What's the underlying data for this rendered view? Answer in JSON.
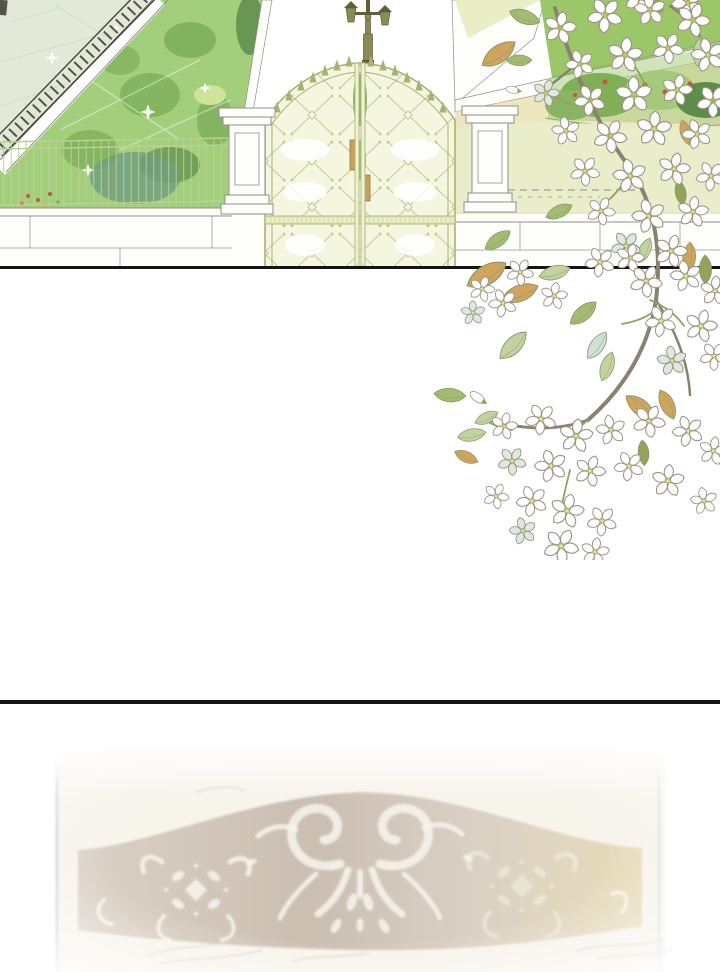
{
  "page": {
    "type": "webtoon-comic-page",
    "width": 720,
    "height": 972,
    "background": "#ffffff",
    "text_content": "none"
  },
  "panels": {
    "garden": {
      "label": "Estate garden scene: pale stone pavement, iron railing, green lawn with wire fence, white stone wall, two stone pillars flanking an ornate pale-green double gate, lamp post, yellow garden wall with flower bed and hedge"
    },
    "blossom": {
      "label": "White five-petal blossom branch with green and tan leaves spilling over the panel border"
    },
    "plaque": {
      "label": "Faded, blurred ornate carved plaque with white scrollwork on a taupe band"
    }
  },
  "palette": {
    "page-bg": "#ffffff",
    "ink": "#141414",
    "pavement": "#e2e9d8",
    "pavement-line": "#c9d5c3",
    "lawn": "#a3cf7d",
    "lawn-dark": "#7cae59",
    "bush-dark": "#5e8c4b",
    "bush-teal": "#6f9c82",
    "iron": "#44443a",
    "wire": "#b9d193",
    "stone": "#fdfdfa",
    "stone-line": "#90908a",
    "gate-fill": "#f4f6df",
    "gate-line": "#a9b272",
    "gate-rail": "#dde5b4",
    "lamp-dark": "#5f5f3c",
    "lamp-mid": "#8b8c55",
    "hedge": "#9cc768",
    "wall-yellow": "#ece7bf",
    "wedge": "#e9eec4",
    "ground": "#eaedc9",
    "bed-green1": "#7fb055",
    "bed-green2": "#a3c97a",
    "bed-red": "#cb5540",
    "bed-orange": "#dd8348",
    "petal": "#ffffff",
    "petal-blue": "#dce9df",
    "petal-line": "#9b9488",
    "stamen": "#cdd06e",
    "stamen-dark": "#a6aa52",
    "leaf-green": "#a4bc72",
    "leaf-sage": "#c3d3a0",
    "leaf-olive": "#93a35c",
    "leaf-tan": "#cfa55e",
    "leaf-blue": "#cfe0d5",
    "leaf-line": "#8a9668",
    "branch": "#8b8170",
    "twig": "#95a25c",
    "plaque-bg": "#f6f2e8",
    "plaque-band-l": "#d5c9ba",
    "plaque-band-m": "#c3b4a2",
    "plaque-band-r": "#e5d6a9",
    "plaque-white": "#f7f3ea",
    "plaque-frame": "#b7c2cc",
    "sketch": "#c7bfad"
  }
}
